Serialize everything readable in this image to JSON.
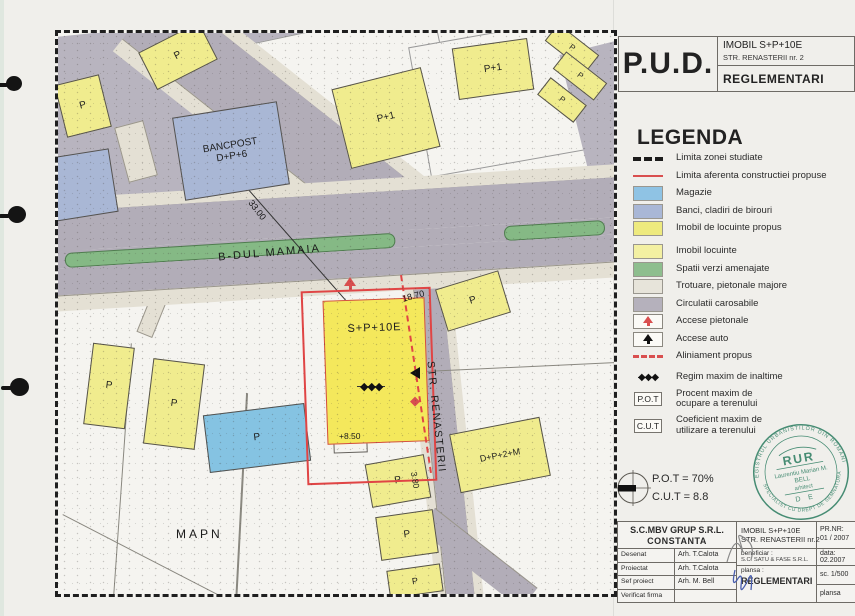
{
  "title_block": {
    "pud": "P.U.D.",
    "project_line1": "IMOBIL  S+P+10E",
    "project_line2": "STR. RENASTERII nr. 2",
    "sheet": "REGLEMENTARI"
  },
  "legend": {
    "title": "LEGENDA",
    "items": [
      {
        "id": "limita-zona",
        "sym": "dash-black",
        "label": "Limita zonei studiate"
      },
      {
        "id": "limita-constructie",
        "sym": "line-red",
        "label": "Limita aferenta constructiei propuse"
      },
      {
        "id": "magazie",
        "sym": "swatch",
        "color": "#8fc3e4",
        "label": "Magazie"
      },
      {
        "id": "banci",
        "sym": "swatch",
        "color": "#a9b7d6",
        "label": "Banci, cladiri de birouri"
      },
      {
        "id": "imobil-propus",
        "sym": "swatch",
        "color": "#eeea7e",
        "label": "Imobil de locuinte propus"
      },
      {
        "id": "imobil-locuinte",
        "sym": "swatch",
        "color": "#f3f0a2",
        "label": "Imobil locuinte",
        "gap": 10
      },
      {
        "id": "spatii-verzi",
        "sym": "swatch",
        "color": "#8ebe8e",
        "label": "Spatii verzi amenajate"
      },
      {
        "id": "trotuare",
        "sym": "swatch",
        "color": "#e7e4da",
        "label": "Trotuare, pietonale  majore"
      },
      {
        "id": "circulatii",
        "sym": "swatch",
        "color": "#b5b1bc",
        "label": "Circulatii carosabile"
      },
      {
        "id": "accese-pietonale",
        "sym": "arrow-red",
        "label": "Accese pietonale"
      },
      {
        "id": "accese-auto",
        "sym": "arrow-black",
        "label": "Accese auto"
      },
      {
        "id": "aliniament",
        "sym": "dash-red",
        "label": "Aliniament  propus"
      },
      {
        "id": "regim-inaltime",
        "sym": "diamonds",
        "label": "Regim maxim de inaltime",
        "gap": 8
      },
      {
        "id": "pot",
        "sym": "box",
        "sym_text": "P.O.T",
        "label": "Procent maxim de\nocupare a terenului",
        "gap": 4
      },
      {
        "id": "cut",
        "sym": "box",
        "sym_text": "C.U.T",
        "label": "Coeficient maxim de\nutilizare a terenului",
        "gap": 4
      }
    ]
  },
  "indicators": {
    "pot": "P.O.T = 70%",
    "cut": "C.U.T = 8.8"
  },
  "stamp": {
    "ring_top": "REGISTRUL URBANISTILOR DIN ROMANIA",
    "ring_bottom": "SPECIALIST CU DREPT DE SEMNATURA",
    "org": "RUR",
    "name": "Laurentiu Marian M.",
    "name2": "BELL",
    "role": "arhitect",
    "right": "D E",
    "color": "#2f7f63"
  },
  "footer": {
    "company": "S.C.MBV GRUP S.R.L.",
    "city": "CONSTANTA",
    "rows": [
      {
        "label": "Desenat",
        "value": "Arh. T.Calota"
      },
      {
        "label": "Proiectat",
        "value": "Arh. T.Calota"
      },
      {
        "label": "Sef proiect",
        "value": "Arh. M. Bell"
      },
      {
        "label": "Verificat firma",
        "value": ""
      }
    ],
    "project_title": "IMOBIL  S+P+10E",
    "project_addr": "STR. RENASTERII nr.2",
    "beneficiar_label": "beneficiar :",
    "beneficiar": "S.C. SATU & FASE S.R.L.",
    "plansa_label": "plansa :",
    "plansa": "REGLEMENTARI",
    "prnr_label": "PR.NR:",
    "prnr": "01 / 2007",
    "data_label": "data:",
    "data": "02.2007",
    "scale": "sc. 1/500",
    "plansa2": "plansa"
  },
  "map": {
    "diamonds": "◆◆◆",
    "colors": {
      "road": "#b2adb8",
      "block_gray": "#b8b4bf",
      "sidewalk": "#e4e0d4",
      "green": "#85b985",
      "yellow": "#f0ec8e",
      "yellow_main": "#f4e85c",
      "blue": "#85c3e2",
      "bluegray": "#a9b7d5",
      "red": "#e04545",
      "paper": "#f5f4f0"
    },
    "blocks": [
      {
        "id": "plaza-nw",
        "x": -20,
        "y": -12,
        "w": 350,
        "h": 215,
        "r": -6,
        "fill": "#b8b4bf"
      },
      {
        "id": "parcel-n-white",
        "x": 185,
        "y": -8,
        "w": 200,
        "h": 100,
        "r": -12,
        "fill": "#f5f4f0",
        "stroke": "#999"
      },
      {
        "id": "parcel-ne-white",
        "x": 360,
        "y": -5,
        "w": 210,
        "h": 130,
        "r": -10,
        "fill": "#f5f4f0",
        "stroke": "#999"
      },
      {
        "id": "gray-ne-corner",
        "x": 520,
        "y": 8,
        "w": 95,
        "h": 165,
        "r": -14,
        "fill": "#b8b4bf"
      },
      {
        "id": "walkway-diag",
        "x": -5,
        "y": 158,
        "w": 290,
        "h": 15,
        "r": -68,
        "fill": "#e4e0d4",
        "stroke": "#9a968c"
      },
      {
        "id": "walkway-bulb",
        "x": 63,
        "y": 90,
        "w": 28,
        "h": 55,
        "r": -15,
        "fill": "#e4e0d4",
        "stroke": "#9a968c"
      }
    ],
    "buildings": [
      {
        "id": "bancpost",
        "label": "BANCPOST\nD+P+6",
        "x": 120,
        "y": 76,
        "w": 104,
        "h": 82,
        "r": -9,
        "fill": "#a9b7d5",
        "fz": 10
      },
      {
        "id": "bldg-bluegray-left",
        "label": "",
        "x": -8,
        "y": 120,
        "w": 62,
        "h": 62,
        "r": -9,
        "fill": "#a9b7d5",
        "fz": 9
      },
      {
        "id": "bldg-p-nw",
        "label": "P",
        "x": 2,
        "y": 46,
        "w": 44,
        "h": 52,
        "r": -14,
        "fill": "#f0ec8e",
        "fz": 10
      },
      {
        "id": "bldg-p-n",
        "label": "P",
        "x": 86,
        "y": 2,
        "w": 66,
        "h": 40,
        "r": -27,
        "fill": "#f0ec8e",
        "fz": 10
      },
      {
        "id": "bldg-p1-mid",
        "label": "P+1",
        "x": 282,
        "y": 44,
        "w": 90,
        "h": 80,
        "r": -14,
        "fill": "#f0ec8e",
        "fz": 10
      },
      {
        "id": "bldg-p1-upper",
        "label": "P+1",
        "x": 397,
        "y": 10,
        "w": 74,
        "h": 50,
        "r": -8,
        "fill": "#f0ec8e",
        "fz": 10
      },
      {
        "id": "bldg-p-sliver1",
        "label": "P",
        "x": 488,
        "y": 4,
        "w": 50,
        "h": 20,
        "r": 38,
        "fill": "#f0ec8e",
        "fz": 8
      },
      {
        "id": "bldg-p-sliver2",
        "label": "P",
        "x": 496,
        "y": 32,
        "w": 50,
        "h": 20,
        "r": 38,
        "fill": "#f0ec8e",
        "fz": 8
      },
      {
        "id": "bldg-p-sliver3",
        "label": "P",
        "x": 481,
        "y": 56,
        "w": 44,
        "h": 20,
        "r": 38,
        "fill": "#f0ec8e",
        "fz": 8
      },
      {
        "id": "bldg-p-right",
        "label": "P",
        "x": 382,
        "y": 246,
        "w": 64,
        "h": 42,
        "r": -17,
        "fill": "#f0ec8e",
        "fz": 10
      },
      {
        "id": "bldg-dp2m",
        "label": "D+P+2+M",
        "x": 396,
        "y": 392,
        "w": 90,
        "h": 58,
        "r": -11,
        "fill": "#f0ec8e",
        "fz": 9
      },
      {
        "id": "bldg-p-sw1",
        "label": "P",
        "x": 30,
        "y": 312,
        "w": 40,
        "h": 80,
        "r": 7,
        "fill": "#f0ec8e",
        "fz": 10
      },
      {
        "id": "bldg-p-sw2",
        "label": "P",
        "x": 90,
        "y": 328,
        "w": 50,
        "h": 84,
        "r": 7,
        "fill": "#f0ec8e",
        "fz": 10
      },
      {
        "id": "magazie-bldg",
        "label": "P",
        "x": 148,
        "y": 376,
        "w": 100,
        "h": 56,
        "r": -7,
        "fill": "#85c3e2",
        "fz": 10
      },
      {
        "id": "bldg-p-s1",
        "label": "P",
        "x": 310,
        "y": 426,
        "w": 58,
        "h": 42,
        "r": -10,
        "fill": "#f0ec8e",
        "fz": 10
      },
      {
        "id": "bldg-p-s2",
        "label": "P",
        "x": 320,
        "y": 480,
        "w": 56,
        "h": 42,
        "r": -8,
        "fill": "#f0ec8e",
        "fz": 10
      },
      {
        "id": "bldg-p-s3",
        "label": "P",
        "x": 330,
        "y": 534,
        "w": 52,
        "h": 26,
        "r": -8,
        "fill": "#f0ec8e",
        "fz": 9
      }
    ],
    "site_label": "S+P+10E",
    "texts": [
      {
        "id": "bdul-mamaia",
        "t": "B-DUL MAMAIA",
        "x": 160,
        "y": 214,
        "r": -5,
        "s": 11,
        "ls": 2
      },
      {
        "id": "str-renasterii",
        "t": "STR. RENASTERII",
        "x": 322,
        "y": 378,
        "r": 84,
        "s": 10.5,
        "ls": 1.5
      },
      {
        "id": "mapn",
        "t": "MAPN",
        "x": 118,
        "y": 494,
        "r": 0,
        "s": 12,
        "ls": 3
      },
      {
        "id": "dim-33",
        "t": "33.00",
        "x": 188,
        "y": 172,
        "r": 52,
        "s": 9,
        "ls": 0
      },
      {
        "id": "dim-18-70",
        "t": "18.70",
        "x": 344,
        "y": 258,
        "r": -15,
        "s": 9,
        "ls": 0
      },
      {
        "id": "dim-8-50",
        "t": "+8.50",
        "x": 281,
        "y": 398,
        "r": 0,
        "s": 8.5,
        "ls": 0
      },
      {
        "id": "dim-3-80",
        "t": "3.80",
        "x": 349,
        "y": 442,
        "r": 80,
        "s": 8.5,
        "ls": 0
      }
    ]
  }
}
